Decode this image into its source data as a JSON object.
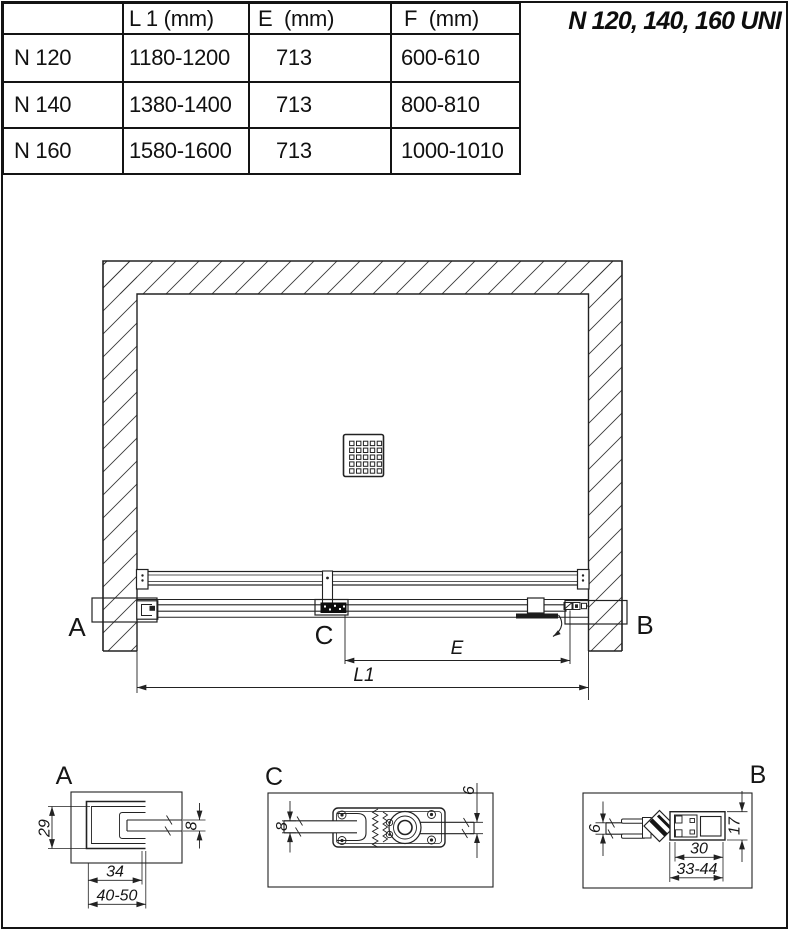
{
  "page": {
    "title": "N 120, 140, 160 UNI"
  },
  "table": {
    "headers": [
      "",
      "L 1 (mm)",
      "E  (mm)",
      "F  (mm)"
    ],
    "rows": [
      {
        "model": "N 120",
        "l1": "1180-1200",
        "e": "713",
        "f": "600-610"
      },
      {
        "model": "N 140",
        "l1": "1380-1400",
        "e": "713",
        "f": "800-810"
      },
      {
        "model": "N 160",
        "l1": "1580-1600",
        "e": "713",
        "f": "1000-1010"
      }
    ]
  },
  "diagram": {
    "label_a": "A",
    "label_b": "B",
    "label_c": "C",
    "dim_e": "E",
    "dim_l1": "L1"
  },
  "detail_a": {
    "label": "A",
    "dim_height": "29",
    "dim_glass": "8",
    "dim_width": "34",
    "dim_range": "40-50"
  },
  "detail_c": {
    "label": "C",
    "dim_glass_left": "8",
    "dim_glass_right": "6"
  },
  "detail_b": {
    "label": "B",
    "dim_glass": "6",
    "dim_height": "17",
    "dim_width": "30",
    "dim_range": "33-44"
  }
}
